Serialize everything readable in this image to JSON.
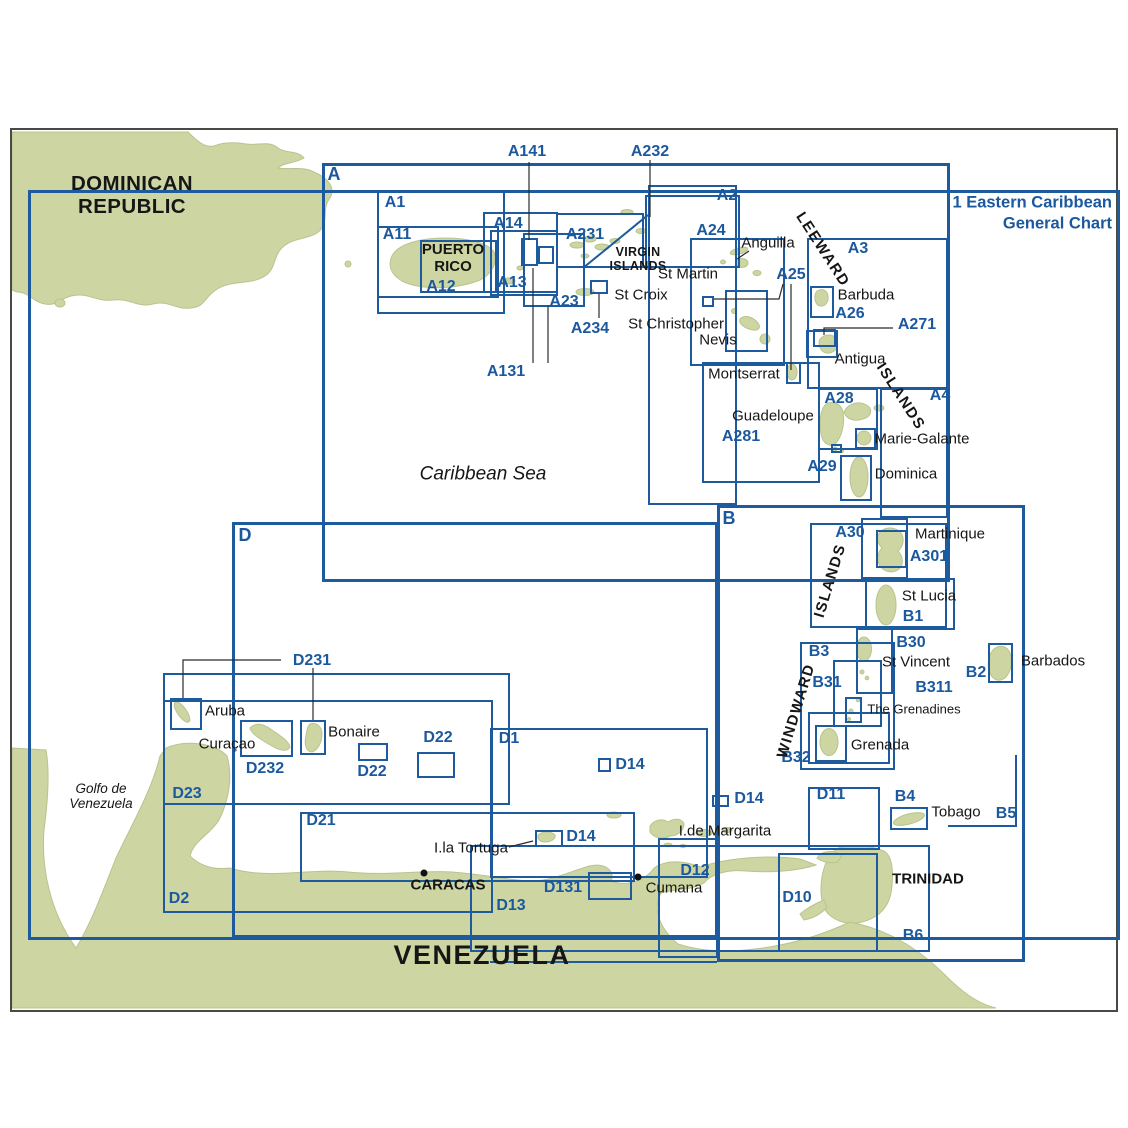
{
  "chart_title": {
    "line1": "1 Eastern Caribbean",
    "line2": "General Chart"
  },
  "colors": {
    "land": "#cdd6a2",
    "land_edge": "#b7c48e",
    "line_blue": "#1d5b9e",
    "label_blue": "#1b589e",
    "text_black": "#161616",
    "sea": "#ffffff",
    "frame": "#4a4a45"
  },
  "boxes": [
    {
      "id": "1",
      "x": 28,
      "y": 190,
      "w": 1092,
      "h": 750,
      "thick": true
    },
    {
      "id": "A",
      "x": 322,
      "y": 163,
      "w": 628,
      "h": 419,
      "thick": true
    },
    {
      "id": "B",
      "x": 717,
      "y": 505,
      "w": 308,
      "h": 457,
      "thick": true
    },
    {
      "id": "D",
      "x": 232,
      "y": 522,
      "w": 486,
      "h": 416,
      "thick": true
    },
    {
      "id": "A1",
      "x": 377,
      "y": 190,
      "w": 128,
      "h": 124
    },
    {
      "id": "A11",
      "x": 377,
      "y": 226,
      "w": 122,
      "h": 72
    },
    {
      "id": "A12",
      "x": 420,
      "y": 240,
      "w": 77,
      "h": 53
    },
    {
      "id": "A14",
      "x": 483,
      "y": 212,
      "w": 75,
      "h": 81
    },
    {
      "id": "A13",
      "x": 490,
      "y": 230,
      "w": 68,
      "h": 66
    },
    {
      "id": "A141-target",
      "x": 521,
      "y": 238,
      "w": 17,
      "h": 28
    },
    {
      "id": "A131-target",
      "x": 538,
      "y": 246,
      "w": 16,
      "h": 18
    },
    {
      "id": "A23",
      "x": 523,
      "y": 233,
      "w": 62,
      "h": 74
    },
    {
      "id": "A231",
      "x": 556,
      "y": 213,
      "w": 88,
      "h": 55
    },
    {
      "id": "A232-box",
      "x": 645,
      "y": 195,
      "w": 95,
      "h": 73
    },
    {
      "id": "A234-box",
      "x": 590,
      "y": 280,
      "w": 18,
      "h": 14
    },
    {
      "id": "A2",
      "x": 648,
      "y": 185,
      "w": 89,
      "h": 320
    },
    {
      "id": "A24",
      "x": 690,
      "y": 238,
      "w": 95,
      "h": 128
    },
    {
      "id": "A25-box",
      "x": 725,
      "y": 290,
      "w": 43,
      "h": 62
    },
    {
      "id": "A25-small",
      "x": 702,
      "y": 296,
      "w": 12,
      "h": 11
    },
    {
      "id": "A3",
      "x": 807,
      "y": 238,
      "w": 141,
      "h": 151
    },
    {
      "id": "A26",
      "x": 810,
      "y": 286,
      "w": 24,
      "h": 32
    },
    {
      "id": "A271-outer",
      "x": 806,
      "y": 330,
      "w": 32,
      "h": 28
    },
    {
      "id": "A271-inner",
      "x": 813,
      "y": 329,
      "w": 23,
      "h": 18
    },
    {
      "id": "Montserrat-box",
      "x": 786,
      "y": 362,
      "w": 15,
      "h": 22
    },
    {
      "id": "A281",
      "x": 702,
      "y": 362,
      "w": 118,
      "h": 121
    },
    {
      "id": "A28",
      "x": 818,
      "y": 388,
      "w": 60,
      "h": 62
    },
    {
      "id": "Saintes-box",
      "x": 831,
      "y": 444,
      "w": 11,
      "h": 9
    },
    {
      "id": "Marie-Galante-box",
      "x": 855,
      "y": 428,
      "w": 21,
      "h": 21
    },
    {
      "id": "A29",
      "x": 840,
      "y": 455,
      "w": 32,
      "h": 46
    },
    {
      "id": "A4",
      "x": 880,
      "y": 388,
      "w": 68,
      "h": 130
    },
    {
      "id": "A30",
      "x": 810,
      "y": 523,
      "w": 137,
      "h": 105
    },
    {
      "id": "Martinique-box",
      "x": 861,
      "y": 518,
      "w": 47,
      "h": 61
    },
    {
      "id": "A301",
      "x": 876,
      "y": 530,
      "w": 31,
      "h": 38
    },
    {
      "id": "B1",
      "x": 865,
      "y": 578,
      "w": 90,
      "h": 52
    },
    {
      "id": "B30",
      "x": 856,
      "y": 628,
      "w": 37,
      "h": 66
    },
    {
      "id": "B31",
      "x": 833,
      "y": 660,
      "w": 49,
      "h": 67
    },
    {
      "id": "Grenadines-box",
      "x": 845,
      "y": 697,
      "w": 17,
      "h": 26
    },
    {
      "id": "B3",
      "x": 800,
      "y": 642,
      "w": 95,
      "h": 128
    },
    {
      "id": "B2",
      "x": 988,
      "y": 643,
      "w": 25,
      "h": 40
    },
    {
      "id": "Grenada-outer",
      "x": 808,
      "y": 712,
      "w": 82,
      "h": 52
    },
    {
      "id": "Grenada-box",
      "x": 815,
      "y": 725,
      "w": 32,
      "h": 37
    },
    {
      "id": "D11",
      "x": 808,
      "y": 787,
      "w": 72,
      "h": 63
    },
    {
      "id": "B4",
      "x": 890,
      "y": 807,
      "w": 38,
      "h": 23
    },
    {
      "id": "D10",
      "x": 778,
      "y": 853,
      "w": 100,
      "h": 99
    },
    {
      "id": "D23",
      "x": 163,
      "y": 673,
      "w": 347,
      "h": 132
    },
    {
      "id": "Aruba-box",
      "x": 170,
      "y": 698,
      "w": 32,
      "h": 32
    },
    {
      "id": "D232",
      "x": 240,
      "y": 720,
      "w": 53,
      "h": 37
    },
    {
      "id": "Bonaire-box",
      "x": 300,
      "y": 720,
      "w": 26,
      "h": 35
    },
    {
      "id": "D22-a",
      "x": 358,
      "y": 743,
      "w": 30,
      "h": 18
    },
    {
      "id": "D22-b",
      "x": 417,
      "y": 752,
      "w": 38,
      "h": 26
    },
    {
      "id": "D1",
      "x": 490,
      "y": 728,
      "w": 218,
      "h": 150
    },
    {
      "id": "D14-a",
      "x": 598,
      "y": 758,
      "w": 13,
      "h": 14
    },
    {
      "id": "D14-b",
      "x": 712,
      "y": 795,
      "w": 17,
      "h": 12
    },
    {
      "id": "D14-c",
      "x": 535,
      "y": 830,
      "w": 28,
      "h": 17
    },
    {
      "id": "D21",
      "x": 300,
      "y": 812,
      "w": 335,
      "h": 70
    },
    {
      "id": "D2",
      "x": 163,
      "y": 700,
      "w": 330,
      "h": 213
    },
    {
      "id": "D13",
      "x": 470,
      "y": 845,
      "w": 460,
      "h": 107
    },
    {
      "id": "D131",
      "x": 588,
      "y": 872,
      "w": 44,
      "h": 28
    },
    {
      "id": "D12",
      "x": 658,
      "y": 838,
      "w": 60,
      "h": 120
    }
  ],
  "labels": [
    {
      "text": "A",
      "x": 334,
      "y": 174,
      "cls": "id-lg"
    },
    {
      "text": "B",
      "x": 729,
      "y": 518,
      "cls": "id-lg"
    },
    {
      "text": "D",
      "x": 245,
      "y": 535,
      "cls": "id-lg"
    },
    {
      "lines": [
        "1 Eastern Caribbean",
        "General Chart"
      ],
      "x": 1112,
      "y": 214,
      "cls": "title",
      "anchor": "r"
    },
    {
      "text": "A1",
      "x": 395,
      "y": 203,
      "cls": "id"
    },
    {
      "text": "A11",
      "x": 397,
      "y": 235,
      "cls": "id"
    },
    {
      "text": "A12",
      "x": 441,
      "y": 287,
      "cls": "id"
    },
    {
      "text": "A13",
      "x": 512,
      "y": 283,
      "cls": "id"
    },
    {
      "text": "A14",
      "x": 508,
      "y": 224,
      "cls": "id"
    },
    {
      "text": "A141",
      "x": 527,
      "y": 152,
      "cls": "id"
    },
    {
      "text": "A131",
      "x": 506,
      "y": 372,
      "cls": "id"
    },
    {
      "text": "A2",
      "x": 727,
      "y": 196,
      "cls": "id"
    },
    {
      "text": "A23",
      "x": 564,
      "y": 302,
      "cls": "id"
    },
    {
      "text": "A231",
      "x": 585,
      "y": 235,
      "cls": "id"
    },
    {
      "text": "A232",
      "x": 650,
      "y": 152,
      "cls": "id"
    },
    {
      "text": "A234",
      "x": 590,
      "y": 329,
      "cls": "id"
    },
    {
      "text": "A24",
      "x": 711,
      "y": 231,
      "cls": "id"
    },
    {
      "text": "A25",
      "x": 791,
      "y": 275,
      "cls": "id"
    },
    {
      "text": "A26",
      "x": 850,
      "y": 314,
      "cls": "id"
    },
    {
      "text": "A271",
      "x": 917,
      "y": 325,
      "cls": "id"
    },
    {
      "text": "A28",
      "x": 839,
      "y": 399,
      "cls": "id"
    },
    {
      "text": "A281",
      "x": 741,
      "y": 437,
      "cls": "id"
    },
    {
      "text": "A29",
      "x": 822,
      "y": 467,
      "cls": "id"
    },
    {
      "text": "A3",
      "x": 858,
      "y": 249,
      "cls": "id"
    },
    {
      "text": "A30",
      "x": 850,
      "y": 533,
      "cls": "id"
    },
    {
      "text": "A301",
      "x": 929,
      "y": 557,
      "cls": "id"
    },
    {
      "text": "A4",
      "x": 940,
      "y": 396,
      "cls": "id"
    },
    {
      "text": "B1",
      "x": 913,
      "y": 617,
      "cls": "id"
    },
    {
      "text": "B2",
      "x": 976,
      "y": 673,
      "cls": "id"
    },
    {
      "text": "B3",
      "x": 819,
      "y": 652,
      "cls": "id"
    },
    {
      "text": "B30",
      "x": 911,
      "y": 643,
      "cls": "id"
    },
    {
      "text": "B31",
      "x": 827,
      "y": 683,
      "cls": "id"
    },
    {
      "text": "B311",
      "x": 934,
      "y": 688,
      "cls": "id"
    },
    {
      "text": "B32",
      "x": 796,
      "y": 758,
      "cls": "id"
    },
    {
      "text": "B4",
      "x": 905,
      "y": 797,
      "cls": "id"
    },
    {
      "text": "B5",
      "x": 1006,
      "y": 814,
      "cls": "id"
    },
    {
      "text": "B6",
      "x": 913,
      "y": 936,
      "cls": "id"
    },
    {
      "text": "D1",
      "x": 509,
      "y": 739,
      "cls": "id"
    },
    {
      "text": "D2",
      "x": 179,
      "y": 899,
      "cls": "id"
    },
    {
      "text": "D10",
      "x": 797,
      "y": 898,
      "cls": "id"
    },
    {
      "text": "D11",
      "x": 831,
      "y": 795,
      "cls": "id"
    },
    {
      "text": "D12",
      "x": 695,
      "y": 871,
      "cls": "id"
    },
    {
      "text": "D13",
      "x": 511,
      "y": 906,
      "cls": "id"
    },
    {
      "text": "D131",
      "x": 563,
      "y": 888,
      "cls": "id"
    },
    {
      "text": "D14",
      "x": 630,
      "y": 765,
      "cls": "id"
    },
    {
      "text": "D14",
      "x": 749,
      "y": 799,
      "cls": "id"
    },
    {
      "text": "D14",
      "x": 581,
      "y": 837,
      "cls": "id"
    },
    {
      "text": "D21",
      "x": 321,
      "y": 821,
      "cls": "id"
    },
    {
      "text": "D22",
      "x": 372,
      "y": 772,
      "cls": "id"
    },
    {
      "text": "D22",
      "x": 438,
      "y": 738,
      "cls": "id"
    },
    {
      "text": "D23",
      "x": 187,
      "y": 794,
      "cls": "id"
    },
    {
      "text": "D231",
      "x": 312,
      "y": 661,
      "cls": "id"
    },
    {
      "text": "D232",
      "x": 265,
      "y": 769,
      "cls": "id"
    },
    {
      "lines": [
        "DOMINICAN",
        "REPUBLIC"
      ],
      "x": 132,
      "y": 196,
      "cls": "country"
    },
    {
      "lines": [
        "PUERTO",
        "RICO"
      ],
      "x": 453,
      "y": 259,
      "cls": "city"
    },
    {
      "lines": [
        "VIRGIN",
        "ISLANDS"
      ],
      "x": 638,
      "y": 259,
      "cls": "city-sm"
    },
    {
      "text": "Anguilla",
      "x": 768,
      "y": 244,
      "cls": "place"
    },
    {
      "text": "St Martin",
      "x": 688,
      "y": 275,
      "cls": "place"
    },
    {
      "text": "St Croix",
      "x": 641,
      "y": 296,
      "cls": "place"
    },
    {
      "text": "St Christopher",
      "x": 676,
      "y": 325,
      "cls": "place"
    },
    {
      "text": "Nevis",
      "x": 718,
      "y": 341,
      "cls": "place"
    },
    {
      "text": "Montserrat",
      "x": 744,
      "y": 375,
      "cls": "place"
    },
    {
      "text": "Barbuda",
      "x": 866,
      "y": 296,
      "cls": "place"
    },
    {
      "text": "Antigua",
      "x": 860,
      "y": 360,
      "cls": "place"
    },
    {
      "text": "Guadeloupe",
      "x": 773,
      "y": 417,
      "cls": "place"
    },
    {
      "text": "Marie-Galante",
      "x": 922,
      "y": 440,
      "cls": "place"
    },
    {
      "text": "Dominica",
      "x": 906,
      "y": 475,
      "cls": "place"
    },
    {
      "text": "Martinique",
      "x": 950,
      "y": 535,
      "cls": "place"
    },
    {
      "text": "St Lucia",
      "x": 929,
      "y": 597,
      "cls": "place"
    },
    {
      "text": "St Vincent",
      "x": 916,
      "y": 663,
      "cls": "place"
    },
    {
      "text": "The Grenadines",
      "x": 914,
      "y": 710,
      "cls": "place-sm"
    },
    {
      "text": "Grenada",
      "x": 880,
      "y": 746,
      "cls": "place"
    },
    {
      "text": "Barbados",
      "x": 1053,
      "y": 662,
      "cls": "place"
    },
    {
      "text": "Tobago",
      "x": 956,
      "y": 813,
      "cls": "place"
    },
    {
      "text": "TRINIDAD",
      "x": 928,
      "y": 880,
      "cls": "city"
    },
    {
      "text": "I.de Margarita",
      "x": 725,
      "y": 832,
      "cls": "place"
    },
    {
      "text": "Cumana",
      "x": 674,
      "y": 889,
      "cls": "place"
    },
    {
      "text": "CARACAS",
      "x": 448,
      "y": 886,
      "cls": "city"
    },
    {
      "text": "I.la Tortuga",
      "x": 471,
      "y": 849,
      "cls": "place"
    },
    {
      "text": "Aruba",
      "x": 225,
      "y": 712,
      "cls": "place"
    },
    {
      "text": "Curaçao",
      "x": 227,
      "y": 745,
      "cls": "place"
    },
    {
      "text": "Bonaire",
      "x": 354,
      "y": 733,
      "cls": "place"
    },
    {
      "text": "VENEZUELA",
      "x": 482,
      "y": 955,
      "cls": "country-xl"
    },
    {
      "text": "Caribbean Sea",
      "x": 483,
      "y": 474,
      "cls": "sea"
    },
    {
      "lines": [
        "Golfo de",
        "Venezuela"
      ],
      "x": 101,
      "y": 796,
      "cls": "sea-sm"
    },
    {
      "text": "LEEWARD",
      "x": 822,
      "y": 250,
      "cls": "arc",
      "rot": 57
    },
    {
      "text": "ISLANDS",
      "x": 900,
      "y": 397,
      "cls": "arc",
      "rot": 57
    },
    {
      "text": "ISLANDS",
      "x": 831,
      "y": 581,
      "cls": "arc",
      "rot": -73
    },
    {
      "text": "WINDWARD",
      "x": 797,
      "y": 711,
      "cls": "arc",
      "rot": -73
    }
  ],
  "leader_lines": [
    [
      [
        529,
        162
      ],
      [
        529,
        240
      ]
    ],
    [
      [
        650,
        160
      ],
      [
        650,
        217
      ]
    ],
    [
      [
        533,
        363
      ],
      [
        533,
        268
      ]
    ],
    [
      [
        548,
        363
      ],
      [
        548,
        306
      ]
    ],
    [
      [
        599,
        294
      ],
      [
        599,
        318
      ]
    ],
    [
      [
        893,
        328
      ],
      [
        824,
        328
      ],
      [
        824,
        335
      ]
    ],
    [
      [
        783,
        284
      ],
      [
        779,
        299
      ],
      [
        714,
        299
      ]
    ],
    [
      [
        791,
        284
      ],
      [
        791,
        370
      ]
    ],
    [
      [
        281,
        660
      ],
      [
        183,
        660
      ],
      [
        183,
        698
      ]
    ],
    [
      [
        313,
        668
      ],
      [
        313,
        720
      ]
    ],
    [
      [
        509,
        847
      ],
      [
        533,
        841
      ]
    ],
    [
      [
        749,
        251
      ],
      [
        737,
        259
      ]
    ]
  ],
  "blue_segments": [
    [
      [
        583,
        268
      ],
      [
        648,
        215
      ]
    ],
    [
      [
        490,
        962
      ],
      [
        717,
        962
      ]
    ],
    [
      [
        1016,
        755
      ],
      [
        1016,
        826
      ],
      [
        948,
        826
      ]
    ]
  ],
  "city_dots": [
    [
      424,
      873
    ],
    [
      638,
      877
    ]
  ]
}
